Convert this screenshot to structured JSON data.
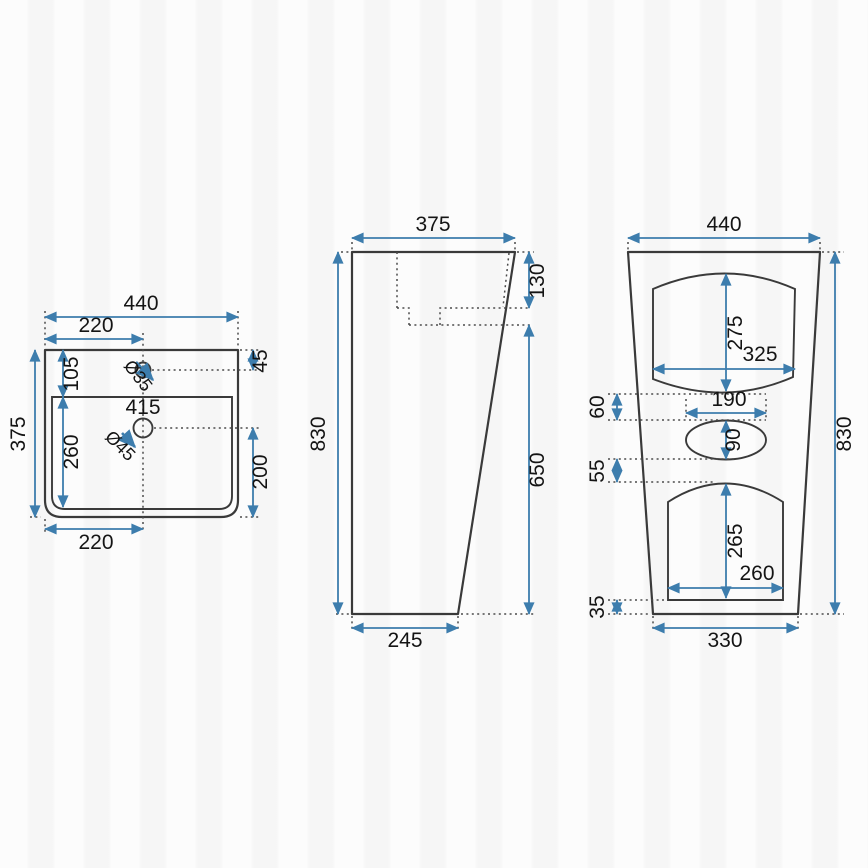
{
  "drawing_type": "technical-drawing",
  "product": "pedestal-washbasin-three-view-dimensions",
  "colors": {
    "dimension_accent": "#3d7dad",
    "outline": "#3a3a3a",
    "background": "#fcfcfc"
  },
  "views": {
    "top": {
      "overall_width": "440",
      "center_offset_top": "220",
      "overall_depth": "375",
      "rim_to_basin": "105",
      "faucet_offset": "45",
      "faucet_hole_diameter": "Ø35",
      "drain_position": "415",
      "drain_hole_diameter": "Ø45",
      "basin_inner_depth": "260",
      "drain_to_front": "200",
      "center_offset_bottom": "220"
    },
    "side": {
      "top_depth": "375",
      "total_height": "830",
      "basin_height": "130",
      "pedestal_height": "650",
      "base_depth": "245"
    },
    "front": {
      "overall_width": "440",
      "total_height": "830",
      "upper_recess_height": "275",
      "upper_recess_width": "325",
      "gap_upper": "60",
      "oval_width": "190",
      "oval_height": "90",
      "gap_middle": "55",
      "lower_recess_height": "265",
      "lower_recess_width": "260",
      "gap_lower": "35",
      "base_width": "330"
    }
  }
}
